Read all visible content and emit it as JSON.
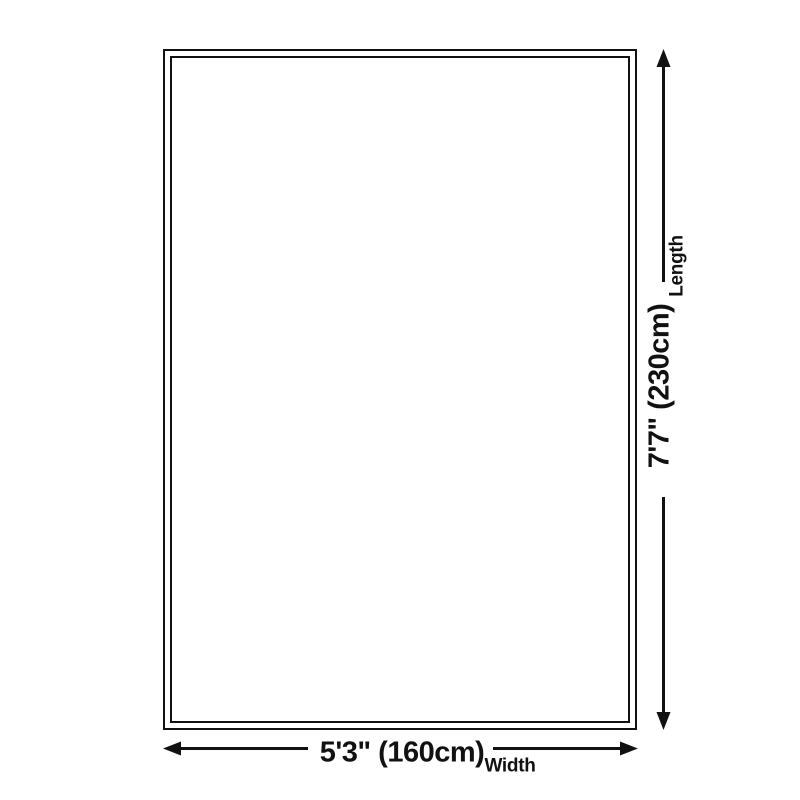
{
  "diagram": {
    "length": {
      "value": "7'7\" (230cm)",
      "label": "Length"
    },
    "width": {
      "value": "5'3\" (160cm)",
      "label": "Width"
    }
  },
  "colors": {
    "line": "#111111",
    "background": "#ffffff"
  }
}
